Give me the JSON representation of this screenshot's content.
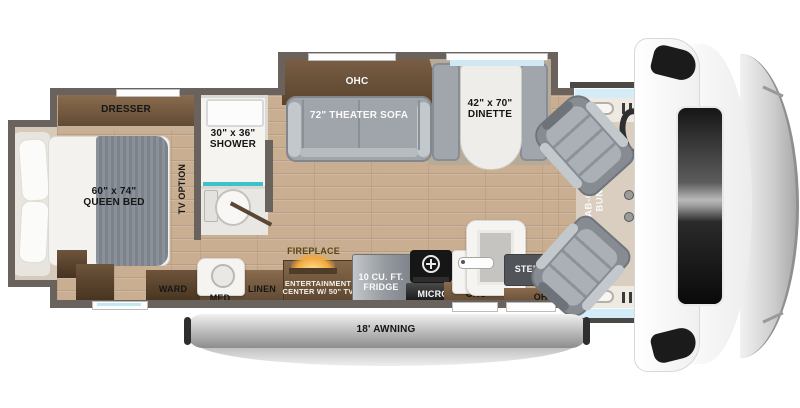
{
  "floorplan": {
    "bedroom": {
      "dresser_label": "DRESSER",
      "bed_size": "60\" x 74\"",
      "bed_type": "QUEEN BED",
      "tv_option_label": "TV OPTION",
      "ward_label": "WARD"
    },
    "bathroom": {
      "shower_size": "30\" x 36\"",
      "shower_label": "SHOWER",
      "med_label": "MED",
      "linen_label": "LINEN"
    },
    "living_slide": {
      "ohc_label": "OHC",
      "sofa_label": "72\" THEATER SOFA",
      "dinette_size": "42\" x 70\"",
      "dinette_label": "DINETTE"
    },
    "galley": {
      "fireplace_label": "FIREPLACE",
      "entertainment_line1": "ENTERTAINMENT",
      "entertainment_line2": "CENTER W/ 50\" TV",
      "fridge_line1": "10 CU. FT.",
      "fridge_line2": "FRIDGE",
      "micro_label": "MICRO",
      "ohc_left_label": "OHC",
      "steps_label": "STEPS",
      "ohc_right_label": "OHC"
    },
    "cab": {
      "bunk_line1": "CAB-OVER",
      "bunk_line2": "BUNK"
    },
    "exterior": {
      "awning_label": "18' AWNING"
    },
    "colors": {
      "wall": "#6a635d",
      "wood_floor": "#c9ae91",
      "cabinet_wood": "#7c644a",
      "upholstery": "#9aa0a6",
      "accent_teal": "#3ec1cd",
      "fireplace_glow": "#f2a93b",
      "cab_window_blue": "#d4ebf8",
      "awning_gray": "#9c9c9c"
    }
  }
}
